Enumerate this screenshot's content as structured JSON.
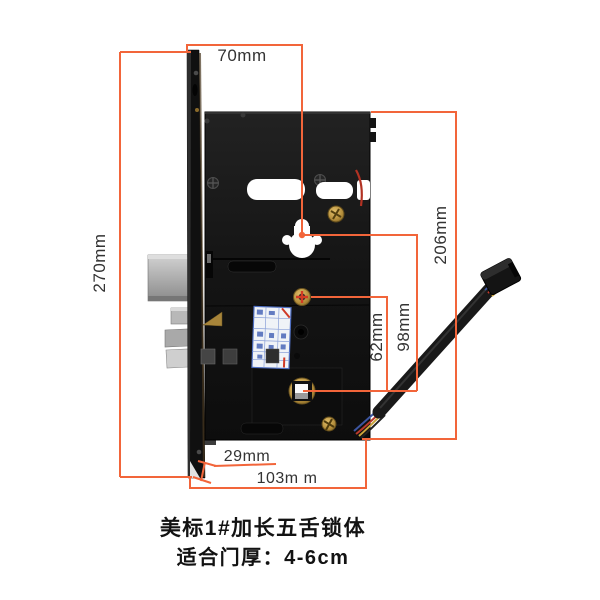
{
  "colors": {
    "dim": "#f2653a",
    "label_text": "#333333",
    "caption_text": "#121212",
    "background": "#ffffff"
  },
  "dimensions": {
    "backset": {
      "label": "70mm"
    },
    "faceplate_height": {
      "label": "270mm"
    },
    "body_height": {
      "label": "206mm"
    },
    "keyhole_to_spindle": {
      "label": "98mm"
    },
    "cylinder_to_spindle": {
      "label": "62mm"
    },
    "faceplate_width": {
      "label": "29mm"
    },
    "body_width": {
      "label": "103m m"
    }
  },
  "captions": {
    "title": "美标1#加长五舌锁体",
    "door_thickness": "适合门厚：4-6cm"
  }
}
